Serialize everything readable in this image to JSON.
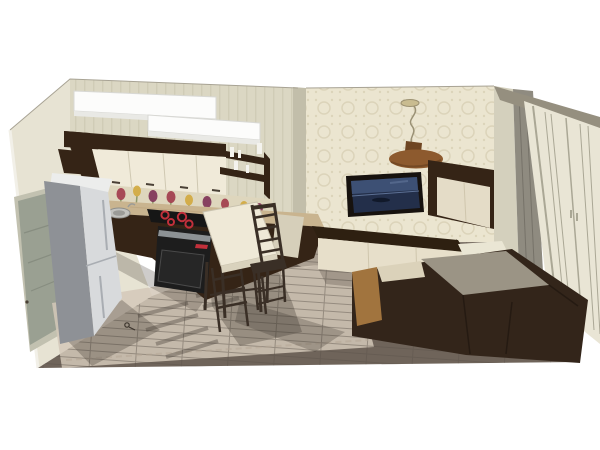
{
  "scene": {
    "description": "3D architectural rendering (cutaway bird's-eye view) of a combined kitchen, dining and living room with dark brown furniture and cream walls",
    "areas": [
      "kitchen",
      "dining-area",
      "living-room",
      "wardrobe-wall"
    ],
    "objects": [
      "ceiling-soffit",
      "upper-cabinets",
      "open-shelves",
      "tulip-backsplash",
      "countertop",
      "sink",
      "cooktop",
      "built-in-oven",
      "base-cabinets",
      "refrigerator",
      "interior-door",
      "dining-table",
      "dining-chairs",
      "pendant-lamp",
      "wall-mounted-tv",
      "wall-cabinet",
      "tv-console",
      "corner-sofa",
      "curtain",
      "wardrobe",
      "wood-floor",
      "sunlight-patch",
      "key-on-floor"
    ]
  },
  "colors": {
    "background": "#ffffff",
    "wallKitchen": "#dbd7c3",
    "wallStripe": "#d0ccb6",
    "wallpaperBase": "#ebe5d0",
    "wallpaperMotif": "#dcd4ba",
    "wallLeft": "#e7e3d3",
    "wallLeftEdge": "#f2f0e8",
    "dividerBand": "#c2beaa",
    "cornerReturn": "#d4d0bd",
    "curtain": "#8f8b80",
    "curtainFold": "#767268",
    "corniceBeam": "#958f7f",
    "wardrobeFace": "#e9e5d5",
    "wardrobeLine": "#aaa795",
    "doorFrame": "#c2c1b0",
    "doorLeaf": "#9aa092",
    "doorLine": "#878d80",
    "floor": "#6f645a",
    "plankLine": "#5c534a",
    "sunPatch": "#d4c8b8",
    "rugBorder": "#b3a693",
    "shadow": "#3c352d",
    "soffit": "#fcfcfb",
    "soffitEdge": "#d8d8d4",
    "soffitFront": "#e9e9e5",
    "cabinetDark": "#352416",
    "cabinetUpper": "#f0ead9",
    "upperLine": "#cfc8b2",
    "handleDark": "#4a4036",
    "counter": "#c9b48f",
    "counterStreak": "#b89e77",
    "backsplash": "#ded6bd",
    "tulipRed": "#a13a4a",
    "tulipPurple": "#7e3157",
    "tulipYellow": "#d2a93e",
    "leafGreen": "#7b8a55",
    "cooktop": "#161616",
    "burner": "#c2303b",
    "oven": "#1d1d1d",
    "ovenSteel": "#9aa0a3",
    "ovenGlass": "#262626",
    "fridgeTop": "#ecedec",
    "fridgeSide": "#8e9196",
    "fridgeFront": "#d8dadc",
    "fridgeLine": "#a9adb2",
    "tableTop": "#efe9d7",
    "tableEdge": "#d6cfba",
    "tableFront": "#d9d2bd",
    "wood": "#3a2f26",
    "tvFrame": "#17120e",
    "tvSky": "#3d5074",
    "tvWater": "#232f4a",
    "tvHorizon": "#5d7195",
    "tvBoat": "#11192a",
    "consoleTop": "#2e2011",
    "consoleFront": "#e7dfca",
    "consoleLine": "#cfc6ad",
    "wallCabinetFront": "#e4dcc7",
    "pendantPlate": "#8d5a2e",
    "pendantPlateDark": "#6e4522",
    "pendantStem": "#9a9175",
    "pendantDisc": "#c9bc90",
    "sofaDark": "#33251a",
    "sofaSeat": "#9b9485",
    "sofaTan": "#a1743e",
    "sofaCream": "#dbd2ba",
    "panelCream": "#eae6d4",
    "bottleWhite": "#f4f3ee",
    "sinkSteel": "#c2c2be",
    "sinkBowl": "#9b9b97"
  }
}
